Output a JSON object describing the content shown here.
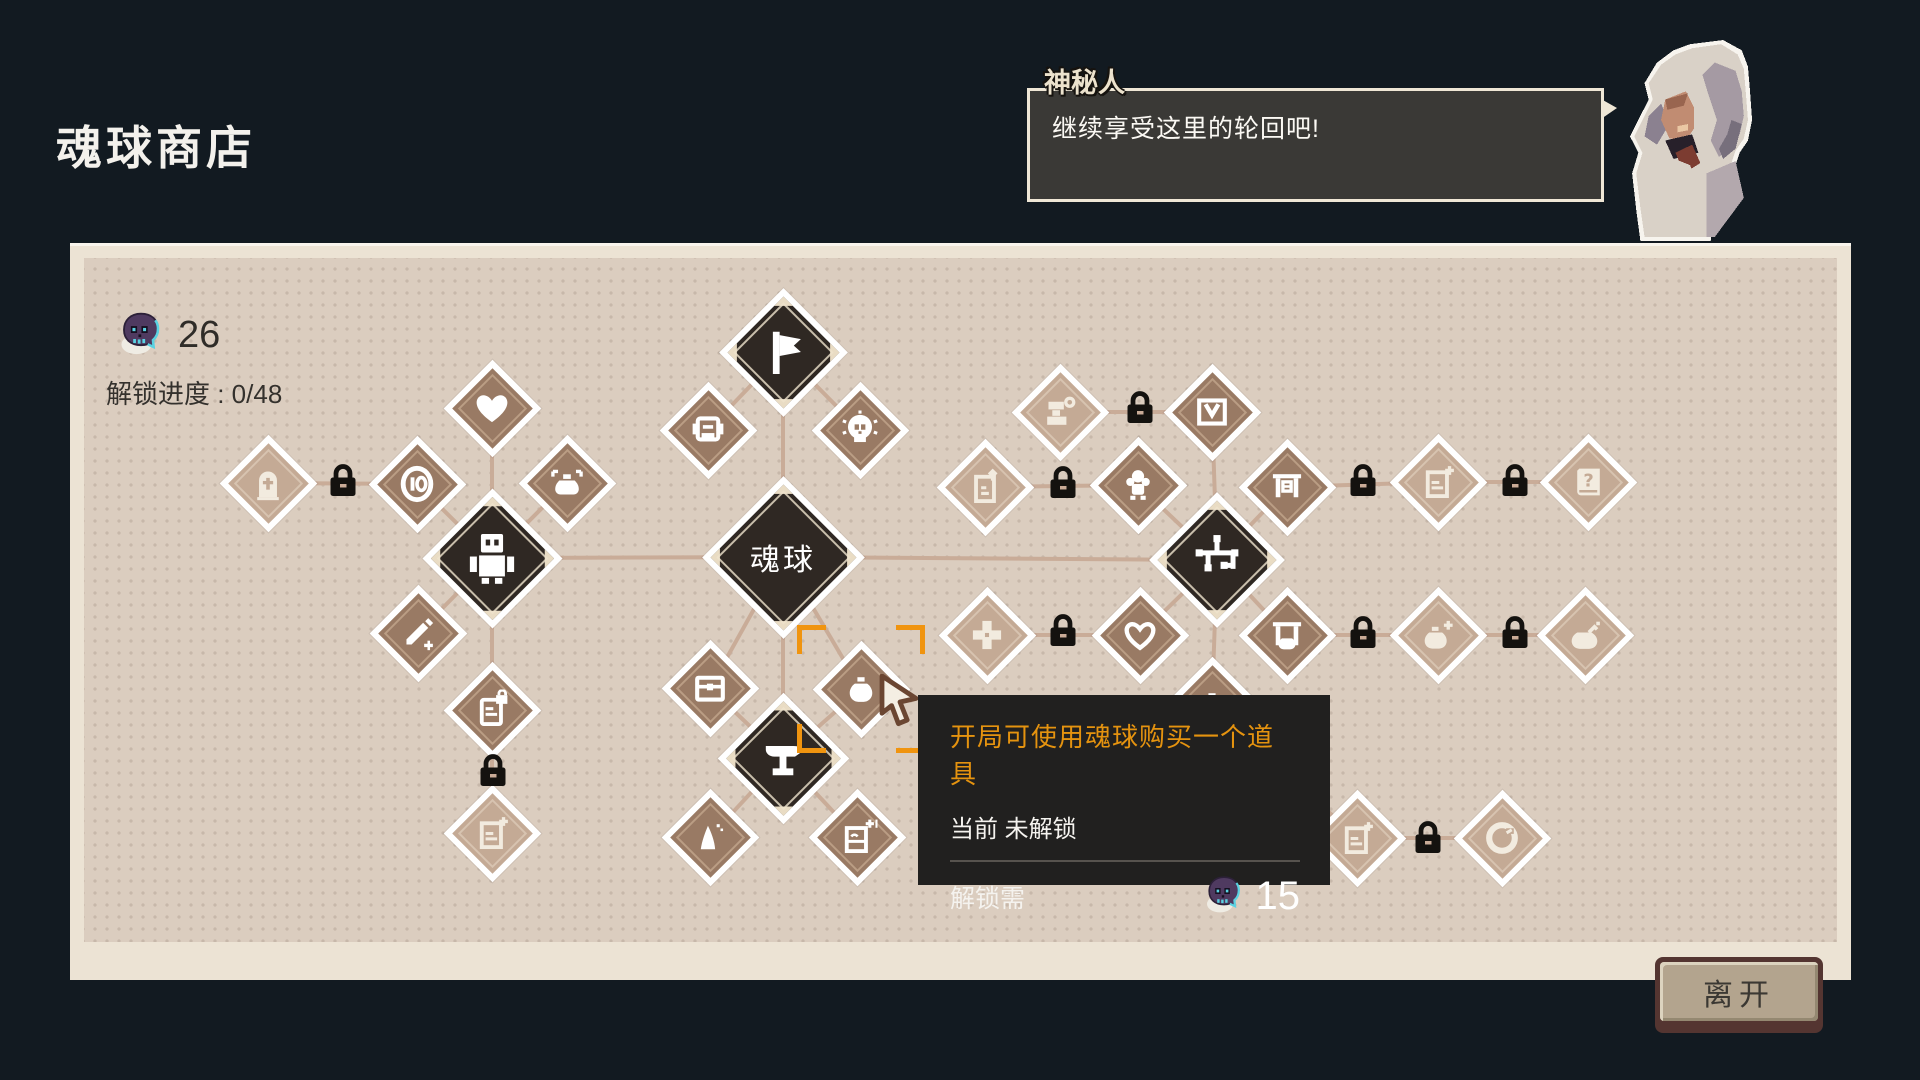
{
  "title": "魂球商店",
  "dialog": {
    "speaker": "神秘人",
    "text": "继续享受这里的轮回吧!"
  },
  "shop": {
    "currency": "26",
    "progress": "解锁进度 : 0/48"
  },
  "tooltip": {
    "title": "开局可使用魂球购买一个道具",
    "status": "当前 未解锁",
    "unlock_label": "解锁需",
    "cost": "15"
  },
  "leave_label": "离开",
  "colors": {
    "background": "#121a21",
    "panel_border": "#ece3d4",
    "panel_beige": "#dbcdbf",
    "panel_dot": "#c7b8aa",
    "connector": "#c9ac98",
    "node_dark": "#2f2823",
    "node_brown": "#997a64",
    "node_faded": "#c4aa95",
    "accent_orange": "#f0940f",
    "tooltip_bg": "#21201f",
    "tooltip_orange": "#e5930f",
    "skull_purple": "#4f3a60",
    "skull_cyan": "#5ad2e2",
    "lock_black": "#14120f"
  },
  "tree": {
    "center_label": "魂球",
    "nodes": [
      {
        "id": "flag",
        "icon": "flag",
        "type": "dark",
        "x": 783,
        "y": 352,
        "size": 128
      },
      {
        "id": "soul-orb",
        "icon": "label",
        "type": "dark",
        "x": 783,
        "y": 557,
        "size": 162,
        "label": "魂球"
      },
      {
        "id": "robot",
        "icon": "robot",
        "type": "dark",
        "x": 492,
        "y": 558,
        "size": 140
      },
      {
        "id": "circuit",
        "icon": "circuit",
        "type": "dark",
        "x": 1217,
        "y": 560,
        "size": 136
      },
      {
        "id": "anvil",
        "icon": "anvil",
        "type": "dark",
        "x": 783,
        "y": 758,
        "size": 132
      },
      {
        "id": "heart",
        "icon": "heart",
        "type": "brown",
        "x": 492,
        "y": 408,
        "size": 98
      },
      {
        "id": "coin-ten",
        "icon": "coin-ten",
        "type": "brown",
        "x": 417,
        "y": 484,
        "size": 98
      },
      {
        "id": "pouch-arrows",
        "icon": "pouch-arrows",
        "type": "brown",
        "x": 567,
        "y": 483,
        "size": 98
      },
      {
        "id": "pencil-plus",
        "icon": "pencil-plus",
        "type": "brown",
        "x": 418,
        "y": 633,
        "size": 98
      },
      {
        "id": "card-lock",
        "icon": "card-lock",
        "type": "brown",
        "x": 492,
        "y": 710,
        "size": 98
      },
      {
        "id": "robot-head",
        "icon": "robot-head",
        "type": "brown",
        "x": 708,
        "y": 430,
        "size": 98
      },
      {
        "id": "skull-badge",
        "icon": "skull-badge",
        "type": "brown",
        "x": 860,
        "y": 430,
        "size": 98
      },
      {
        "id": "chest",
        "icon": "chest",
        "type": "brown",
        "x": 710,
        "y": 688,
        "size": 98
      },
      {
        "id": "potion-pouch",
        "icon": "pouch",
        "type": "brown",
        "x": 861,
        "y": 689,
        "size": 98,
        "selected": true
      },
      {
        "id": "candle",
        "icon": "candle",
        "type": "brown",
        "x": 710,
        "y": 837,
        "size": 98
      },
      {
        "id": "card-plus-one",
        "icon": "card-plus-one",
        "type": "brown",
        "x": 857,
        "y": 837,
        "size": 98
      },
      {
        "id": "box-v",
        "icon": "box-v",
        "type": "brown",
        "x": 1212,
        "y": 412,
        "size": 98
      },
      {
        "id": "doll",
        "icon": "doll",
        "type": "brown",
        "x": 1138,
        "y": 485,
        "size": 98
      },
      {
        "id": "banner-box",
        "icon": "banner-box",
        "type": "brown",
        "x": 1287,
        "y": 487,
        "size": 98
      },
      {
        "id": "heart-outline",
        "icon": "heart-outline",
        "type": "brown",
        "x": 1140,
        "y": 635,
        "size": 98
      },
      {
        "id": "banner-pouch",
        "icon": "banner-pouch",
        "type": "brown",
        "x": 1287,
        "y": 635,
        "size": 98
      },
      {
        "id": "mystery",
        "icon": "pouch",
        "type": "brown",
        "x": 1212,
        "y": 705,
        "size": 98
      },
      {
        "id": "tombstone",
        "icon": "tombstone",
        "type": "faded",
        "x": 268,
        "y": 483,
        "size": 98
      },
      {
        "id": "card-faded",
        "icon": "card-sparkle",
        "type": "faded",
        "x": 492,
        "y": 833,
        "size": 98
      },
      {
        "id": "press-gear",
        "icon": "press-gear",
        "type": "faded",
        "x": 1060,
        "y": 412,
        "size": 98
      },
      {
        "id": "card-arrow-up",
        "icon": "card-arrow-up",
        "type": "faded",
        "x": 985,
        "y": 487,
        "size": 98
      },
      {
        "id": "plus-cross",
        "icon": "plus-cross",
        "type": "faded",
        "x": 987,
        "y": 635,
        "size": 98
      },
      {
        "id": "card-sparkle",
        "icon": "card-sparkle",
        "type": "faded",
        "x": 1438,
        "y": 482,
        "size": 98
      },
      {
        "id": "book-question",
        "icon": "book-question",
        "type": "faded",
        "x": 1588,
        "y": 482,
        "size": 98
      },
      {
        "id": "potion-sparkle",
        "icon": "potion-sparkle",
        "type": "faded",
        "x": 1438,
        "y": 635,
        "size": 98
      },
      {
        "id": "kettle",
        "icon": "kettle-spark",
        "type": "faded",
        "x": 1585,
        "y": 635,
        "size": 98
      },
      {
        "id": "doc-sparkle",
        "icon": "card-sparkle",
        "type": "faded",
        "x": 1357,
        "y": 838,
        "size": 98
      },
      {
        "id": "coin-ring",
        "icon": "coin-ring",
        "type": "faded",
        "x": 1502,
        "y": 838,
        "size": 98
      }
    ],
    "locks": [
      [
        343,
        483
      ],
      [
        493,
        773
      ],
      [
        1140,
        410
      ],
      [
        1063,
        485
      ],
      [
        1063,
        633
      ],
      [
        1363,
        483
      ],
      [
        1515,
        483
      ],
      [
        1363,
        635
      ],
      [
        1515,
        635
      ],
      [
        1428,
        840
      ]
    ],
    "links": [
      [
        268,
        483,
        417,
        484
      ],
      [
        417,
        484,
        492,
        558
      ],
      [
        492,
        408,
        492,
        558
      ],
      [
        567,
        483,
        492,
        558
      ],
      [
        418,
        633,
        492,
        558
      ],
      [
        492,
        558,
        492,
        710
      ],
      [
        492,
        710,
        492,
        833
      ],
      [
        492,
        558,
        783,
        557
      ],
      [
        783,
        352,
        783,
        557
      ],
      [
        783,
        352,
        708,
        430
      ],
      [
        783,
        352,
        860,
        430
      ],
      [
        783,
        557,
        710,
        688
      ],
      [
        783,
        557,
        861,
        689
      ],
      [
        783,
        557,
        783,
        758
      ],
      [
        710,
        688,
        783,
        758
      ],
      [
        861,
        689,
        783,
        758
      ],
      [
        783,
        758,
        710,
        837
      ],
      [
        783,
        758,
        857,
        837
      ],
      [
        783,
        557,
        1217,
        560
      ],
      [
        1060,
        412,
        1212,
        412
      ],
      [
        1212,
        412,
        1217,
        560
      ],
      [
        985,
        487,
        1138,
        485
      ],
      [
        1138,
        485,
        1217,
        560
      ],
      [
        1287,
        487,
        1217,
        560
      ],
      [
        987,
        635,
        1140,
        635
      ],
      [
        1140,
        635,
        1217,
        560
      ],
      [
        1287,
        635,
        1217,
        560
      ],
      [
        1217,
        560,
        1212,
        705
      ],
      [
        1287,
        487,
        1438,
        482
      ],
      [
        1438,
        482,
        1588,
        482
      ],
      [
        1287,
        635,
        1438,
        635
      ],
      [
        1438,
        635,
        1585,
        635
      ],
      [
        1212,
        705,
        1357,
        838
      ],
      [
        1357,
        838,
        1502,
        838
      ]
    ]
  }
}
